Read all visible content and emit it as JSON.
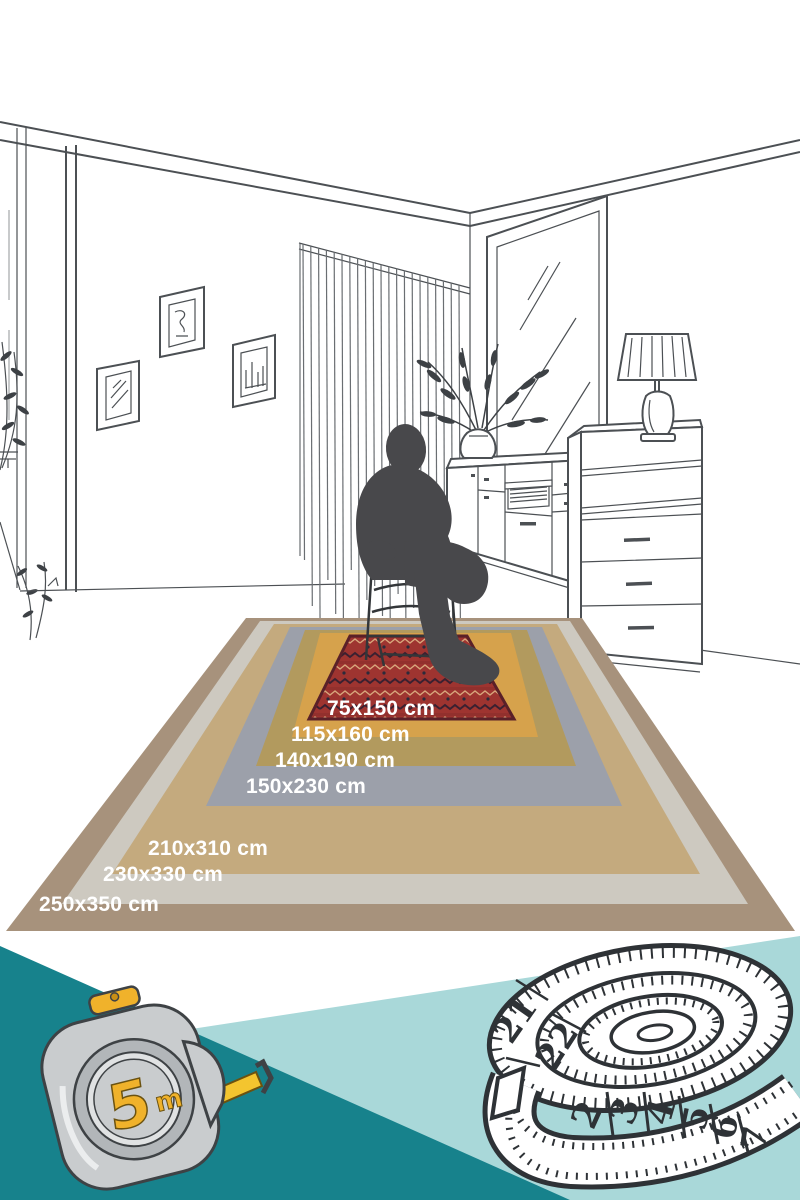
{
  "page": {
    "kind": "rug size guide infographic"
  },
  "rugs": [
    {
      "label": "250x350 cm",
      "color": "#a7927c",
      "points": "246,618 582,618 795,931 6,931"
    },
    {
      "label": "230x330 cm",
      "color": "#cdc9c0",
      "points": "260,621 570,621 748,904 62,904"
    },
    {
      "label": "210x310 cm",
      "color": "#c4aa7e",
      "points": "274,624 557,624 700,874 112,874"
    },
    {
      "label": "150x230 cm",
      "color": "#9ca0aa",
      "points": "290,627 542,627 622,806 206,806"
    },
    {
      "label": "140x190 cm",
      "color": "#b29a5e",
      "points": "305,630 527,630 576,766 256,766"
    },
    {
      "label": "115x160 cm",
      "color": "#d6a24c",
      "points": "320,633 511,633 538,737 292,737"
    },
    {
      "label": "75x150 cm",
      "color": "#9e3430",
      "points": "350,636 467,636 514,719 309,719"
    }
  ],
  "bottom": {
    "dark_teal": "#17828c",
    "light_teal": "#a9d8d9",
    "tape_measure": {
      "value": "5",
      "unit": "m"
    },
    "coil_numbers": [
      "21",
      "22",
      "2",
      "3",
      "4",
      "5",
      "6",
      "7"
    ]
  },
  "art": {
    "line_color": "#4c5054",
    "silhouette_color": "#48484b"
  }
}
